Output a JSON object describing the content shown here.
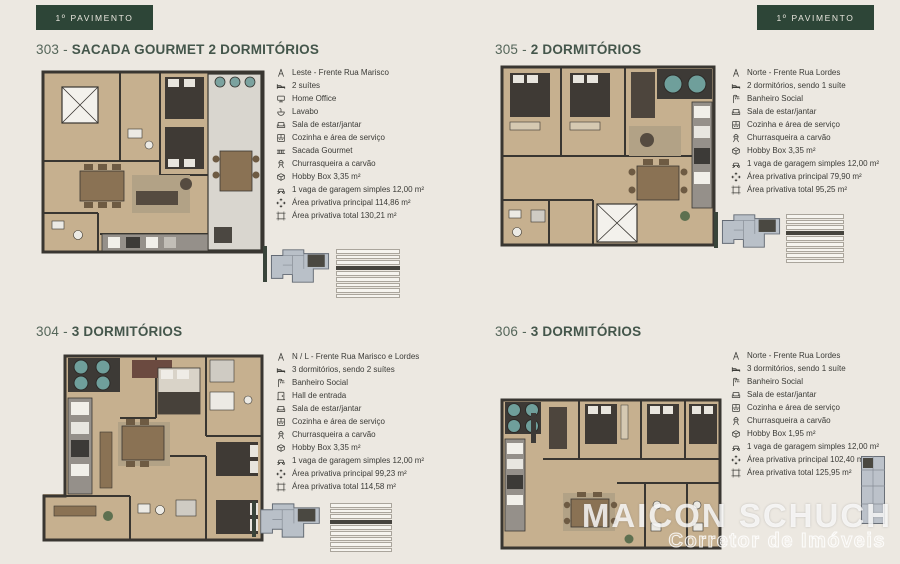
{
  "page": {
    "background": "#ece8e1"
  },
  "badge": {
    "label": "1º PAVIMENTO"
  },
  "watermark": {
    "name": "MAICON SCHUCH",
    "subtitle": "Corretor de Imóveis"
  },
  "colors": {
    "badge_bg": "#2d4537",
    "badge_text": "#e8e6de",
    "title_text": "#44564b",
    "body_text": "#3b3b37",
    "page_bg": "#ece8e1",
    "plan_floor": "#c6b08f",
    "plan_wall": "#393631",
    "balcony_floor": "#d9d6cf",
    "key_highlight": "#46443e"
  },
  "units": [
    {
      "prefix": "303 - ",
      "name": "SACADA GOURMET 2 DORMITÓRIOS",
      "features": [
        {
          "icon": "compass-icon",
          "text": "Leste - Frente Rua Marisco"
        },
        {
          "icon": "bed-icon",
          "text": "2 suítes"
        },
        {
          "icon": "desk-icon",
          "text": "Home Office"
        },
        {
          "icon": "sink-icon",
          "text": "Lavabo"
        },
        {
          "icon": "sofa-icon",
          "text": "Sala de estar/jantar"
        },
        {
          "icon": "kitchen-icon",
          "text": "Cozinha e área de serviço"
        },
        {
          "icon": "balcony-icon",
          "text": "Sacada Gourmet"
        },
        {
          "icon": "grill-icon",
          "text": "Churrasqueira a carvão"
        },
        {
          "icon": "box-icon",
          "text": "Hobby Box 3,35 m²"
        },
        {
          "icon": "car-icon",
          "text": "1 vaga de garagem simples 12,00 m²"
        },
        {
          "icon": "expand-icon",
          "text": "Área privativa principal 114,86 m²"
        },
        {
          "icon": "area-icon",
          "text": "Área privativa total 130,21 m²"
        }
      ]
    },
    {
      "prefix": "305 - ",
      "name": "2 DORMITÓRIOS",
      "features": [
        {
          "icon": "compass-icon",
          "text": "Norte - Frente Rua Lordes"
        },
        {
          "icon": "bed-icon",
          "text": "2 dormitórios, sendo 1 suíte"
        },
        {
          "icon": "shower-icon",
          "text": "Banheiro Social"
        },
        {
          "icon": "sofa-icon",
          "text": "Sala de estar/jantar"
        },
        {
          "icon": "kitchen-icon",
          "text": "Cozinha e área de serviço"
        },
        {
          "icon": "grill-icon",
          "text": "Churrasqueira a carvão"
        },
        {
          "icon": "box-icon",
          "text": "Hobby Box 3,35 m²"
        },
        {
          "icon": "car-icon",
          "text": "1 vaga de garagem simples 12,00 m²"
        },
        {
          "icon": "expand-icon",
          "text": "Área privativa principal 79,90 m²"
        },
        {
          "icon": "area-icon",
          "text": "Área privativa total 95,25 m²"
        }
      ]
    },
    {
      "prefix": "304 - ",
      "name": "3 DORMITÓRIOS",
      "features": [
        {
          "icon": "compass-icon",
          "text": "N / L - Frente Rua Marisco e Lordes"
        },
        {
          "icon": "bed-icon",
          "text": "3 dormitórios, sendo 2 suítes"
        },
        {
          "icon": "shower-icon",
          "text": "Banheiro Social"
        },
        {
          "icon": "door-icon",
          "text": "Hall de entrada"
        },
        {
          "icon": "sofa-icon",
          "text": "Sala de estar/jantar"
        },
        {
          "icon": "kitchen-icon",
          "text": "Cozinha e área de serviço"
        },
        {
          "icon": "grill-icon",
          "text": "Churrasqueira a carvão"
        },
        {
          "icon": "box-icon",
          "text": "Hobby Box 3,35 m²"
        },
        {
          "icon": "car-icon",
          "text": "1 vaga de garagem simples 12,00 m²"
        },
        {
          "icon": "expand-icon",
          "text": "Área privativa principal 99,23 m²"
        },
        {
          "icon": "area-icon",
          "text": "Área privativa total 114,58 m²"
        }
      ]
    },
    {
      "prefix": "306 - ",
      "name": "3 DORMITÓRIOS",
      "features": [
        {
          "icon": "compass-icon",
          "text": "Norte - Frente Rua Lordes"
        },
        {
          "icon": "bed-icon",
          "text": "3 dormitórios, sendo 1 suíte"
        },
        {
          "icon": "shower-icon",
          "text": "Banheiro Social"
        },
        {
          "icon": "sofa-icon",
          "text": "Sala de estar/jantar"
        },
        {
          "icon": "kitchen-icon",
          "text": "Cozinha e área de serviço"
        },
        {
          "icon": "grill-icon",
          "text": "Churrasqueira a carvão"
        },
        {
          "icon": "box-icon",
          "text": "Hobby Box 1,95 m²"
        },
        {
          "icon": "car-icon",
          "text": "1 vaga de garagem simples 12,00 m²"
        },
        {
          "icon": "expand-icon",
          "text": "Área privativa principal 102,40 m²"
        },
        {
          "icon": "area-icon",
          "text": "Área privativa total 125,95 m²"
        }
      ]
    }
  ]
}
